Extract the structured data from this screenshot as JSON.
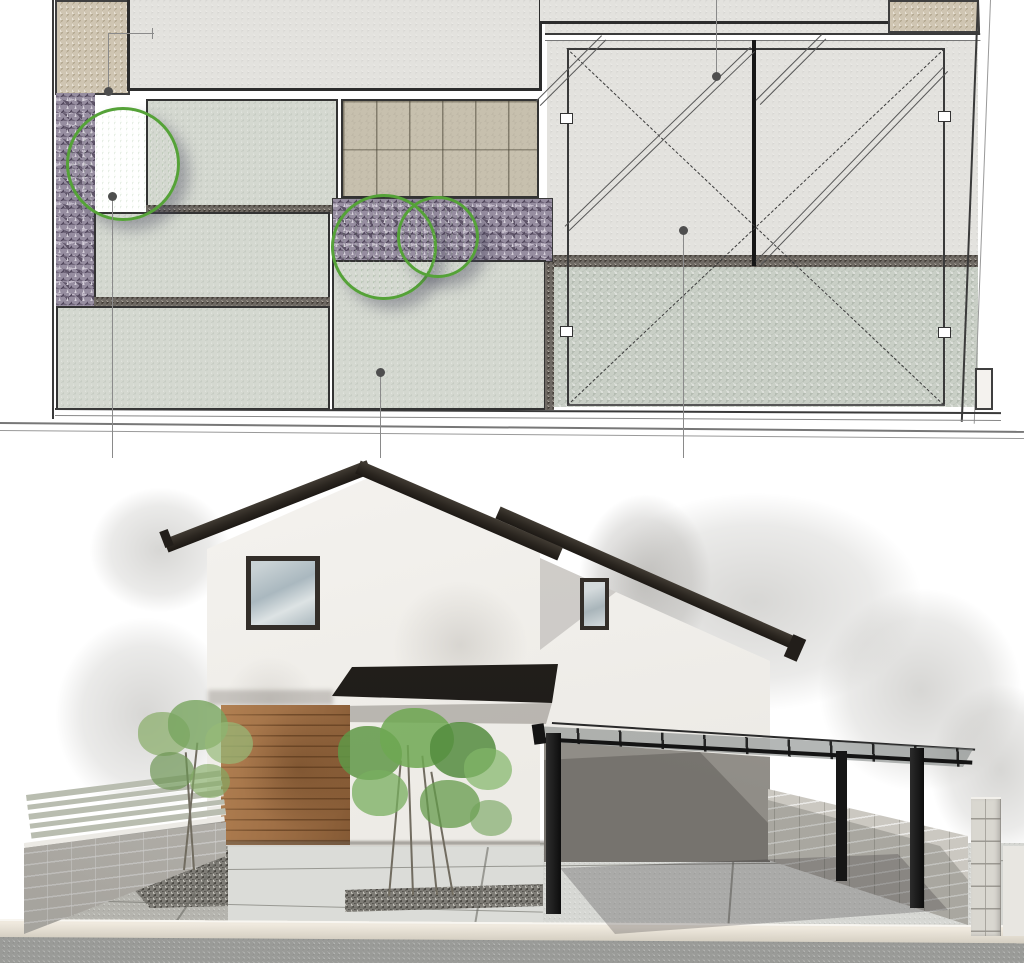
{
  "scene": {
    "kind": "architectural presentation drawing, no visible text",
    "views": [
      {
        "id": "site-plan",
        "label": "landscape site plan (top half)"
      },
      {
        "id": "front-elevation",
        "label": "front elevation rendering (bottom half)"
      }
    ]
  },
  "palette": {
    "ink": "#3a3a3a",
    "leader_line": "#8a8a8a",
    "leader_dot": "#4e4e4e",
    "concrete_light": "#e3e2de",
    "concrete_pad": "#d4d8d0",
    "gravel_green": "#c9cfc6",
    "gravel_purple": "#968da0",
    "gravel_beige": "#cfc5b2",
    "gravel_dark": "#6e6963",
    "paving_tile": "#c7c0ae",
    "tree_outline": "#55a238",
    "tree_fill": "#a7cb95",
    "roof_dark": "#2b2620",
    "wall_white": "#f3f1ed",
    "window_frame": "#332e29",
    "window_glass": "#b9c4c9",
    "wood_screen": "#a17147",
    "awning": "#282421",
    "carport_frame": "#161616",
    "carport_panel": "#8f9492",
    "backdrop_wall": "#9a968f",
    "block_wall": "#cfccc5",
    "fence_slat": "#b9bdb0",
    "pebble": "#7e7c76",
    "ground_concrete": "#d9dad6",
    "curb": "#ddd6c9",
    "road": "#9a9b98",
    "foliage": "#6ea551",
    "trunk": "#716c60"
  },
  "plan": {
    "areas": [
      {
        "name": "building-footprint",
        "material": "building interior pavement, heavy outline",
        "color_key": "concrete_light"
      },
      {
        "name": "gravel-strip-left",
        "material": "beige gravel",
        "color_key": "gravel_beige"
      },
      {
        "name": "gravel-block-top-right",
        "material": "beige gravel",
        "color_key": "gravel_beige"
      },
      {
        "name": "planting-gravel-left-column",
        "material": "dark decorative gravel",
        "color_key": "gravel_purple"
      },
      {
        "name": "planting-gravel-middle-strip",
        "material": "dark decorative gravel",
        "color_key": "gravel_purple"
      },
      {
        "name": "concrete-pad-a",
        "material": "concrete terrace",
        "color_key": "concrete_pad"
      },
      {
        "name": "concrete-pad-b",
        "material": "concrete terrace",
        "color_key": "concrete_pad"
      },
      {
        "name": "concrete-pad-c",
        "material": "concrete terrace",
        "color_key": "concrete_pad"
      },
      {
        "name": "concrete-pad-d",
        "material": "concrete terrace",
        "color_key": "concrete_pad"
      },
      {
        "name": "paving-tile-walk",
        "material": "rectangular tiles, running bond",
        "color_key": "paving_tile"
      },
      {
        "name": "parking-pavement",
        "material": "carport concrete slab",
        "color_key": "concrete_light"
      },
      {
        "name": "parking-gravel-apron",
        "material": "green-grey gravel apron",
        "color_key": "gravel_green"
      },
      {
        "name": "drainage-edging",
        "material": "dark gravel edging strips",
        "color_key": "gravel_dark"
      }
    ],
    "parking": {
      "bays": 2,
      "markings": [
        "full-area dashed X",
        "paired double diagonal braces in each bay",
        "small clamp squares on side frames",
        "heavy centre divider"
      ]
    },
    "trees": [
      {
        "id": "plan-tree-1",
        "cx": 123,
        "cy": 164,
        "r": 57
      },
      {
        "id": "plan-tree-2",
        "cx": 384,
        "cy": 247,
        "r": 53
      },
      {
        "id": "plan-tree-3",
        "cx": 438,
        "cy": 237,
        "r": 41
      }
    ],
    "leader_callouts": [
      {
        "id": "L1",
        "anchor": {
          "x": 108,
          "y": 91
        },
        "route": "up then right with end tick"
      },
      {
        "id": "L2",
        "anchor": {
          "x": 716,
          "y": 76
        },
        "route": "straight up to top edge"
      },
      {
        "id": "L3",
        "anchor": {
          "x": 112,
          "y": 196
        },
        "route": "down past plan edge"
      },
      {
        "id": "L4",
        "anchor": {
          "x": 380,
          "y": 372
        },
        "route": "down past plan edge"
      },
      {
        "id": "L5",
        "anchor": {
          "x": 683,
          "y": 230
        },
        "route": "down past plan edge"
      }
    ]
  },
  "elevation": {
    "house": {
      "wall_finish": "white render",
      "roof": "dark grey gable with lower mono-pitch wing",
      "windows": [
        {
          "id": "square-window",
          "w": 74,
          "h": 74
        },
        {
          "id": "slit-window",
          "w": 29,
          "h": 52
        }
      ],
      "entrance": {
        "canopy": "dark flat awning",
        "screen": "horizontal wood-slat screen"
      }
    },
    "carport": {
      "structure": "black steel flat-roof carport",
      "roof": "translucent grey panels with black rafters",
      "posts": 3
    },
    "boundary": {
      "left": "concrete block wall with horizontal slat fence on top",
      "right": "concrete block wall and block pier"
    },
    "landscape": {
      "trees": "two deciduous planting groups",
      "beds": "dark pebble mulch strips"
    },
    "ground": {
      "surfaces": [
        "concrete approach slabs",
        "speckled gravel",
        "kerb",
        "asphalt road"
      ]
    }
  }
}
